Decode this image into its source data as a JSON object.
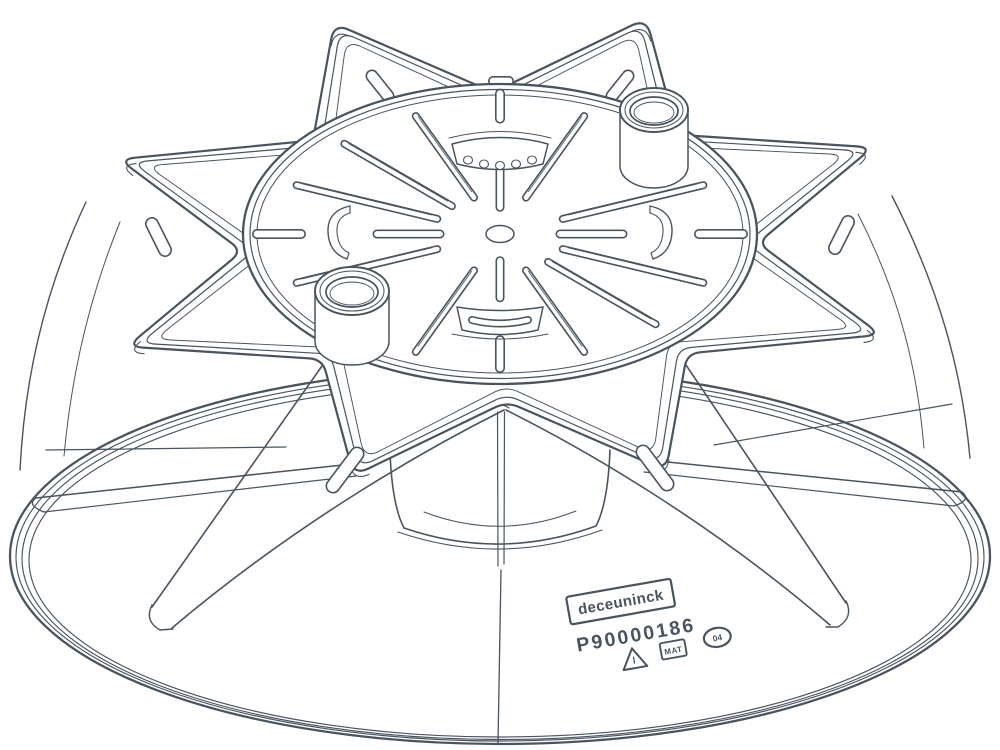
{
  "colors": {
    "line": "#49545f",
    "background": "#ffffff"
  },
  "markings": {
    "brand_logo": "deceuninck",
    "part_number": "P90000186",
    "material_badge": "MAT",
    "date_stamp": "04"
  },
  "icons": {
    "warning": "warning-triangle-icon",
    "material": "material-badge-icon",
    "date": "date-stamp-oval-icon"
  }
}
